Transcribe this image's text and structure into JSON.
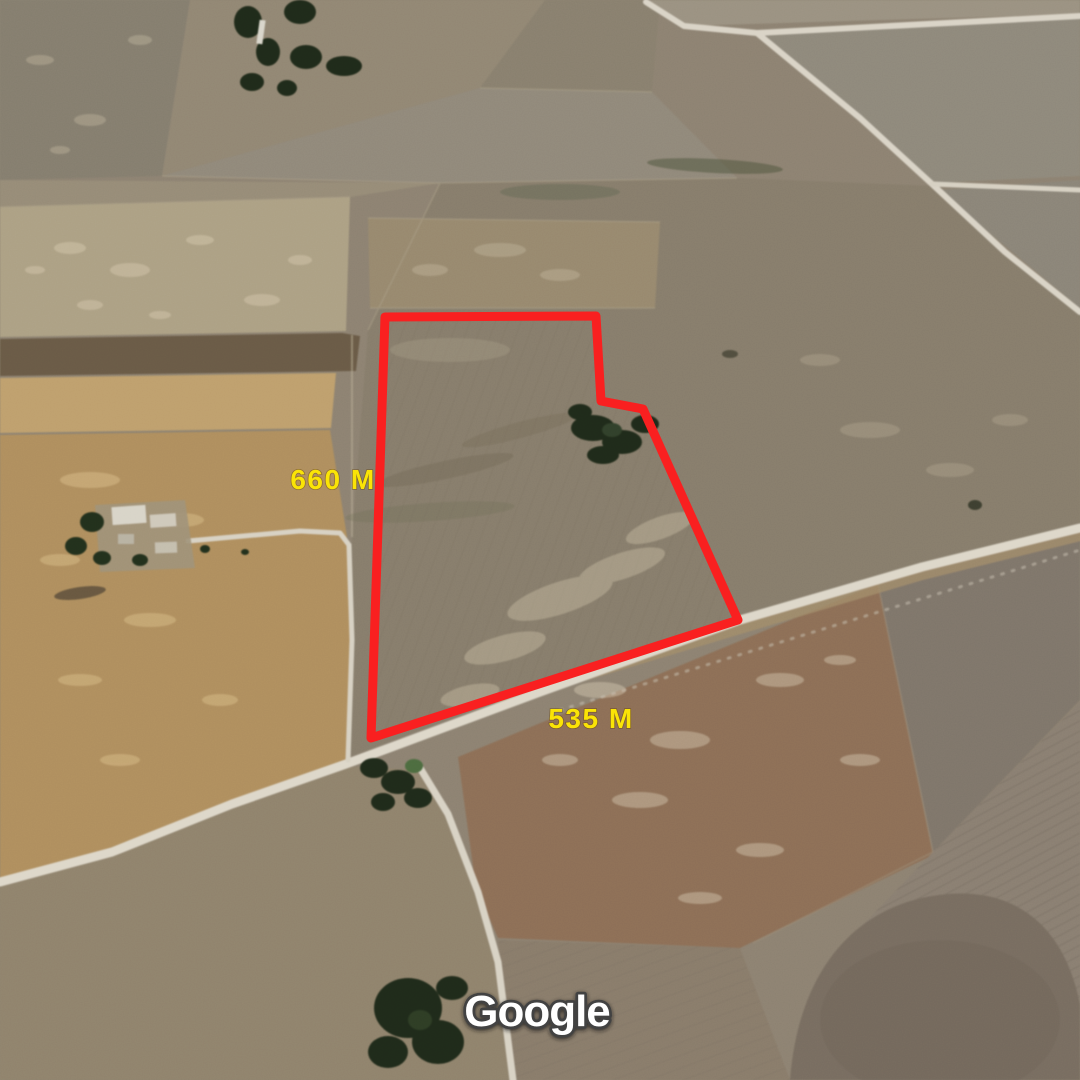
{
  "map": {
    "provider_watermark": "Google",
    "parcel": {
      "outline_color": "#f91f1f",
      "points": "385,317 596,316 601,401 643,409 738,620 371,738"
    },
    "label_color": "#fae405",
    "measurements": [
      {
        "label": "660 M",
        "x": 333,
        "y": 489
      },
      {
        "label": "535 M",
        "x": 591,
        "y": 728
      }
    ]
  }
}
